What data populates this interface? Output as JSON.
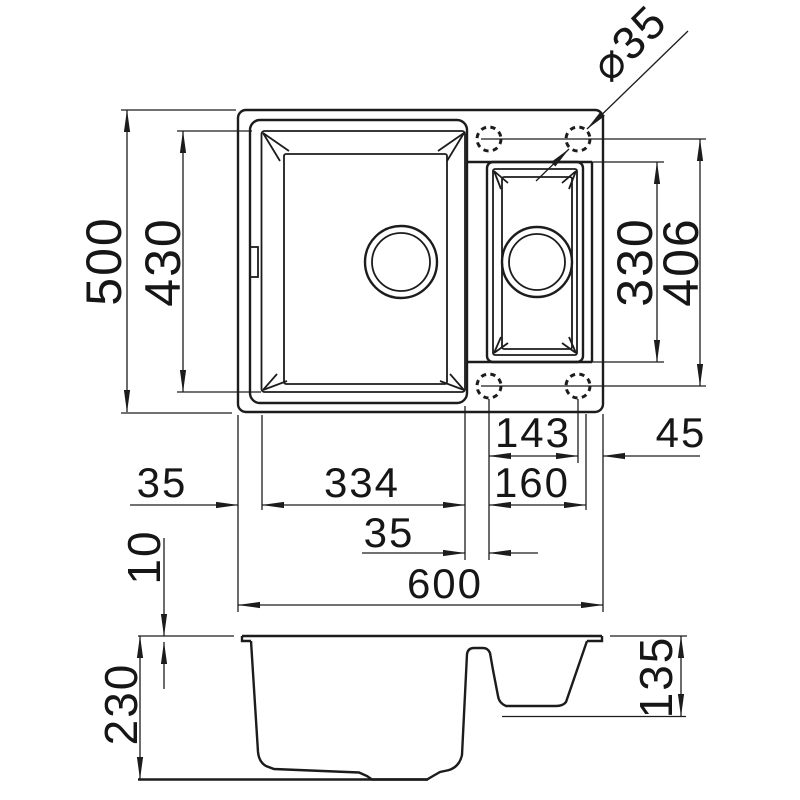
{
  "labels": {
    "overall_depth": "500",
    "main_bowl_depth": "430",
    "small_bowl_length": "330",
    "tap_holes_span": "406",
    "tap_hole_diameter": "⌀35",
    "tap_holes_spacing": "143",
    "right_edge_offset": "45",
    "left_edge_offset": "35",
    "main_bowl_length": "334",
    "tap_hole_to_rim": "160",
    "bowl_to_hole_gap": "35",
    "overall_length": "600",
    "rim_thickness": "10",
    "overall_height": "230",
    "small_bowl_depth": "135"
  }
}
